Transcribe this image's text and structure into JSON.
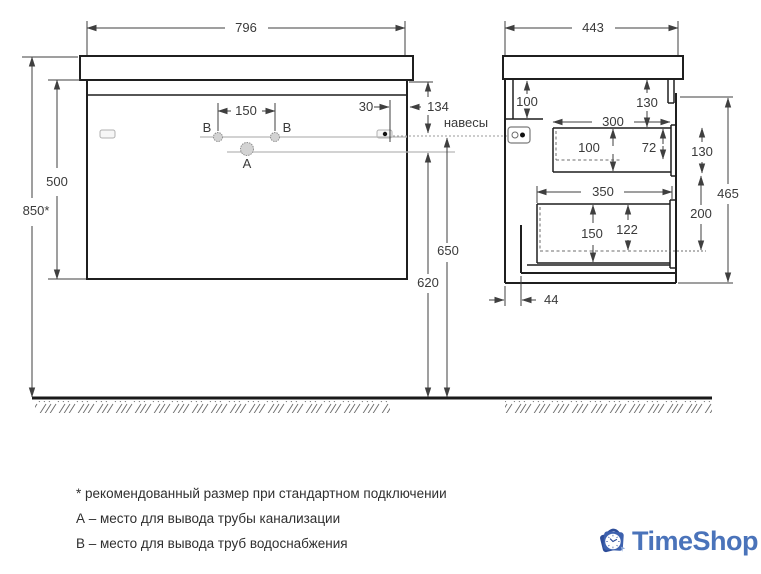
{
  "drawing": {
    "front_view": {
      "width": "796",
      "height": "500",
      "mount_height": "850*",
      "hole_offset": "134",
      "holes_spacing": "150",
      "hanger_offset": "30",
      "water_line": "650",
      "drain_line": "620",
      "label_b_left": "B",
      "label_b_right": "B",
      "label_a": "A"
    },
    "side_view": {
      "depth": "443",
      "rail_height": "100",
      "top_gap": "130",
      "drawer1_depth": "300",
      "drawer1_height": "100",
      "drawer1_inner": "72",
      "drawer1_side": "130",
      "total_height": "465",
      "drawer2_depth": "350",
      "drawer2_height": "150",
      "drawer2_inner": "122",
      "drawer2_side": "200",
      "back_gap": "44"
    },
    "callout_hangers": "навесы"
  },
  "notes": [
    "* рекомендованный размер при стандартном подключении",
    "А – место для вывода трубы канализации",
    "В – место для вывода труб водоснабжения"
  ],
  "logo": {
    "text": "TimeShop"
  },
  "colors": {
    "line_dark": "#222222",
    "line_dim": "#3f3f3f",
    "line_gray": "#b8b8b8",
    "logo_blue": "#4a73ba",
    "logo_dark_blue": "#2d4d99",
    "logo_mid_blue": "#3d61ae"
  }
}
